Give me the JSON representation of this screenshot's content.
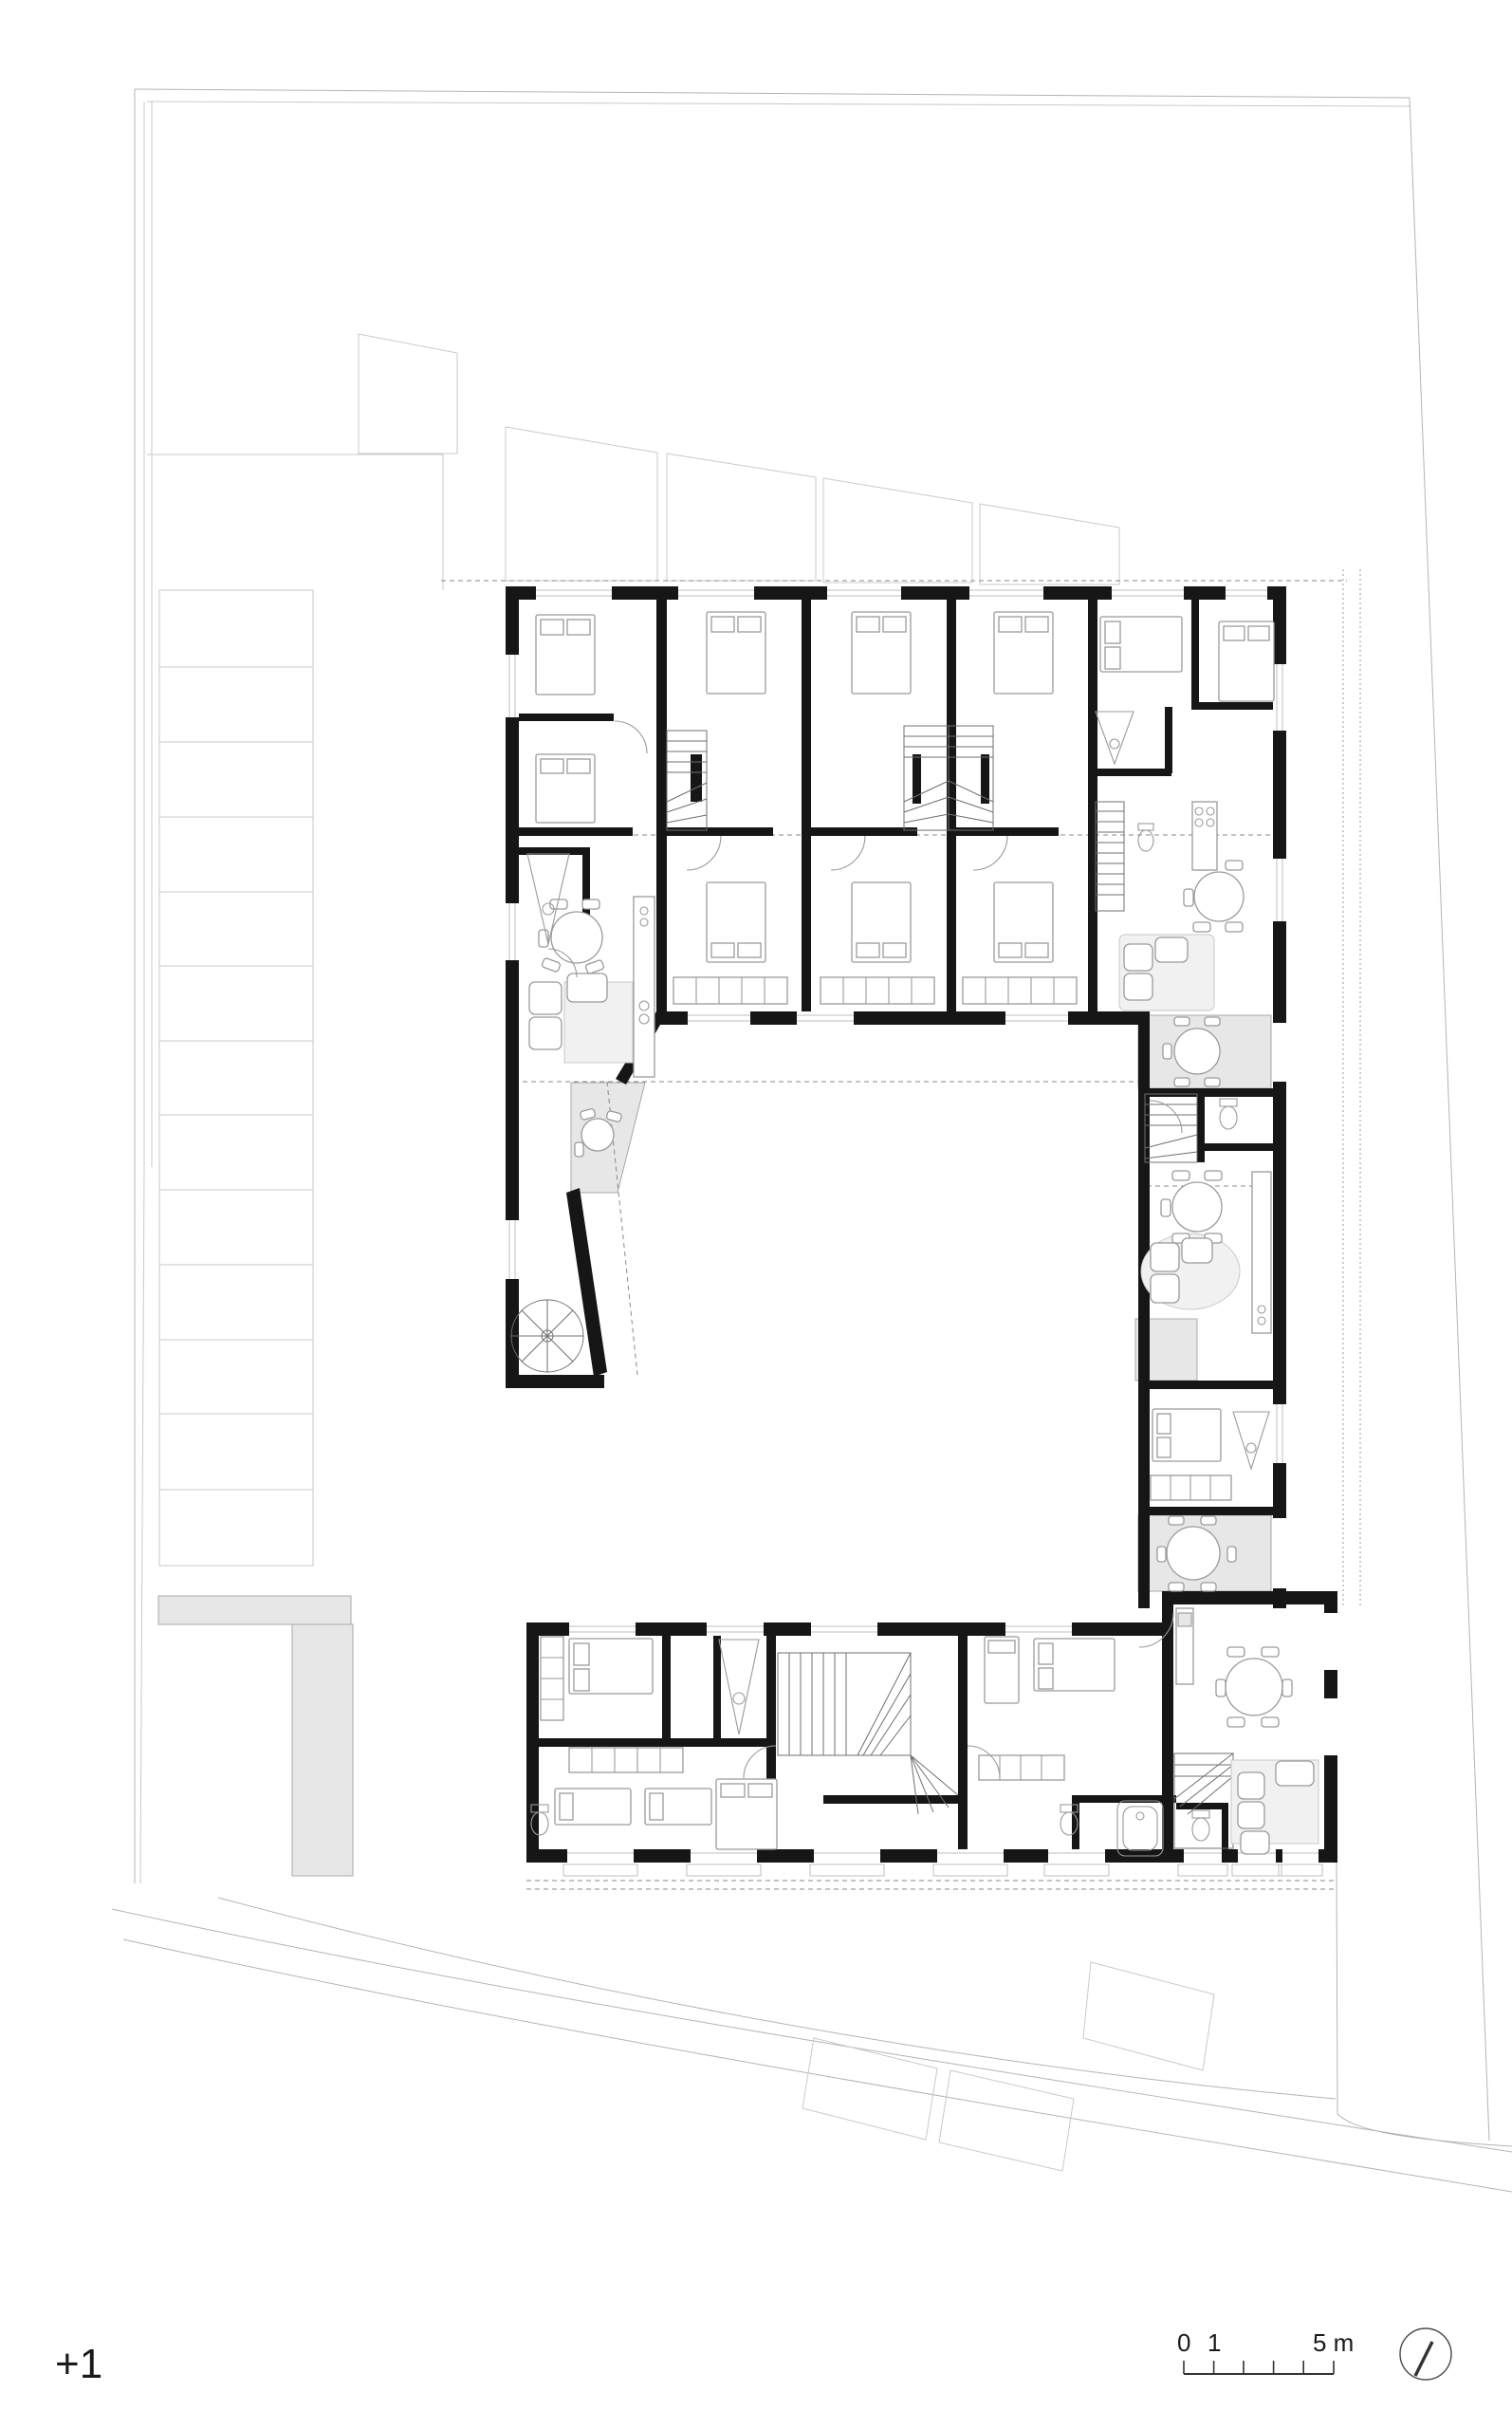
{
  "drawing": {
    "type": "architectural-floor-plan",
    "floor_label": "+1"
  },
  "scale_bar": {
    "tick_zero": "0",
    "tick_one": "1",
    "tick_five": "5 m"
  },
  "colors": {
    "wall": "#161616",
    "patio": "#e7e7e7",
    "paper": "#ffffff"
  },
  "icons": {
    "north_indicator": "circle-with-slash"
  }
}
